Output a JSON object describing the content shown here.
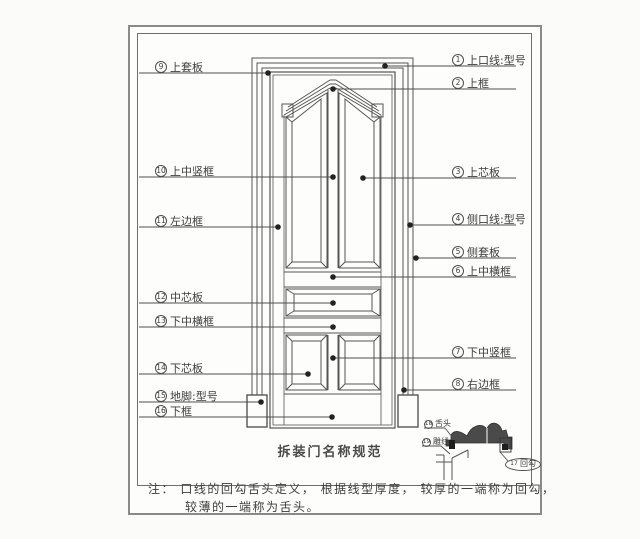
{
  "title": "拆装门名称规范",
  "note": {
    "line1": "注： 口线的回勾舌头定义， 根据线型厚度， 较厚的一端称为回勾，",
    "line2": "较薄的一端称为舌头。"
  },
  "labels": {
    "right": [
      {
        "num": "1",
        "text": "上口线:型号"
      },
      {
        "num": "2",
        "text": "上框"
      },
      {
        "num": "3",
        "text": "上芯板"
      },
      {
        "num": "4",
        "text": "侧口线:型号"
      },
      {
        "num": "5",
        "text": "侧套板"
      },
      {
        "num": "6",
        "text": "上中横框"
      },
      {
        "num": "7",
        "text": "下中竖框"
      },
      {
        "num": "8",
        "text": "右边框"
      }
    ],
    "left": [
      {
        "num": "9",
        "text": "上套板"
      },
      {
        "num": "10",
        "text": "上中竖框"
      },
      {
        "num": "11",
        "text": "左边框"
      },
      {
        "num": "12",
        "text": "中芯板"
      },
      {
        "num": "13",
        "text": "下中横框"
      },
      {
        "num": "14",
        "text": "下芯板"
      },
      {
        "num": "15",
        "text": "地脚:型号"
      },
      {
        "num": "16",
        "text": "下框"
      }
    ],
    "detail": [
      {
        "num": "17",
        "text": "回勾"
      },
      {
        "num": "18",
        "text": "舌头"
      },
      {
        "num": "19",
        "text": "雕线"
      }
    ]
  },
  "colors": {
    "line": "#555555",
    "text": "#3d3d3d",
    "background": "#fbfbfa",
    "profile_fill": "#4a4a4a"
  }
}
